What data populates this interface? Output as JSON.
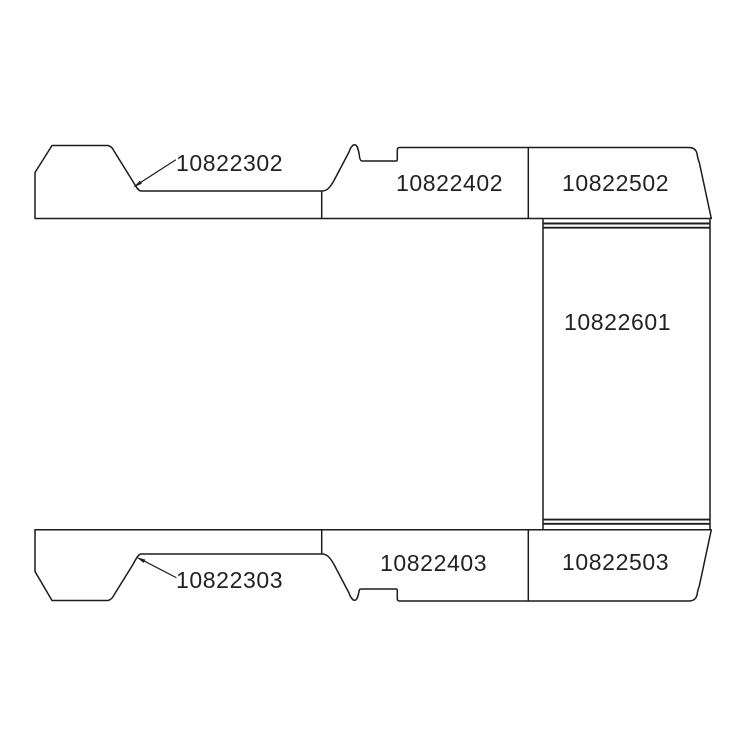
{
  "page": {
    "background": "#ffffff"
  },
  "diagram": {
    "type": "vehicle-panel-parts-diagram",
    "line_color": "#1c1c1c",
    "text_color": "#222222",
    "parts": {
      "top_left": "10822302",
      "top_middle": "10822402",
      "top_right": "10822502",
      "right_panel": "10822601",
      "bottom_left": "10822303",
      "bottom_middle": "10822403",
      "bottom_right": "10822503"
    }
  }
}
